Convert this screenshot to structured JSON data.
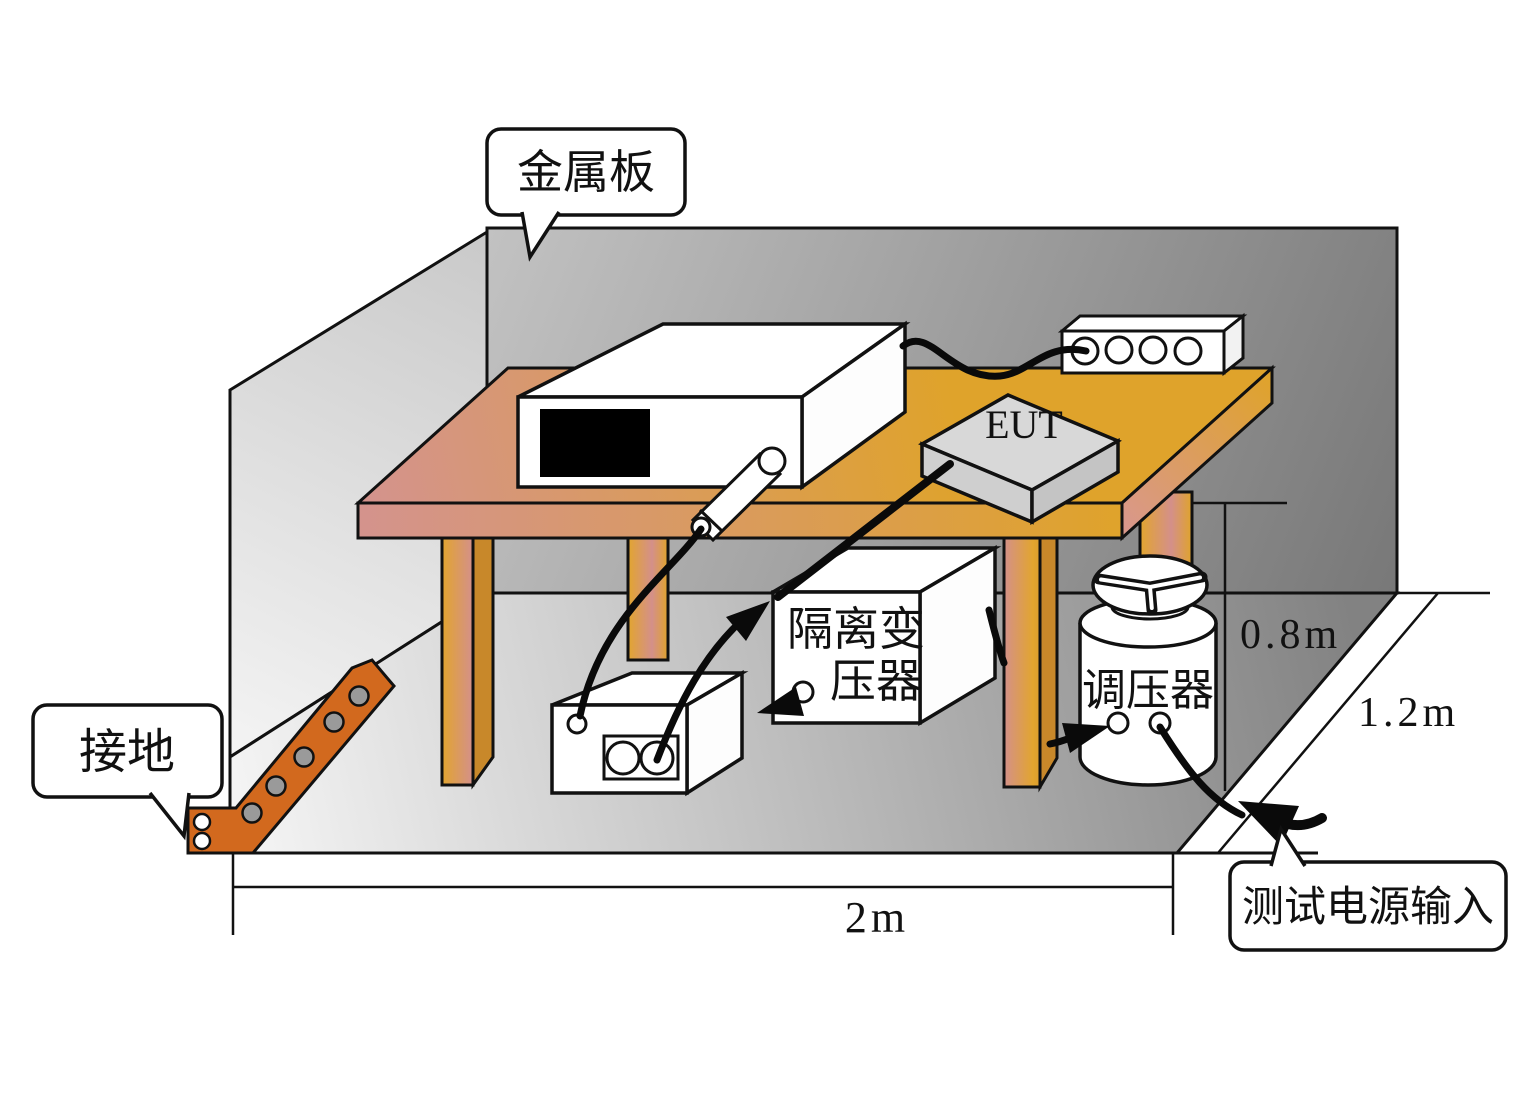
{
  "labels": {
    "metal_plate": "金属板",
    "grounding": "接地",
    "test_power_input": "测试电源输入",
    "eut": "EUT",
    "isolation_transformer_line1": "隔离变",
    "isolation_transformer_line2": "压器",
    "voltage_regulator": "调压器"
  },
  "dimensions": {
    "width": "2m",
    "height": "0.8m",
    "depth": "1.2m"
  },
  "colors": {
    "table_wood_gold": "#dfa32b",
    "table_shade_pink": "#d4938d",
    "copper_strap_orange": "#d2691e",
    "back_wall_dark": "#7a7a7a",
    "back_wall_light": "#bdbdbd",
    "side_wall_light": "#efefef",
    "floor_light": "#f2f2f2",
    "floor_dark": "#858585",
    "cable_black": "#0a0a0a",
    "eut_gray": "#d8d8d8"
  }
}
